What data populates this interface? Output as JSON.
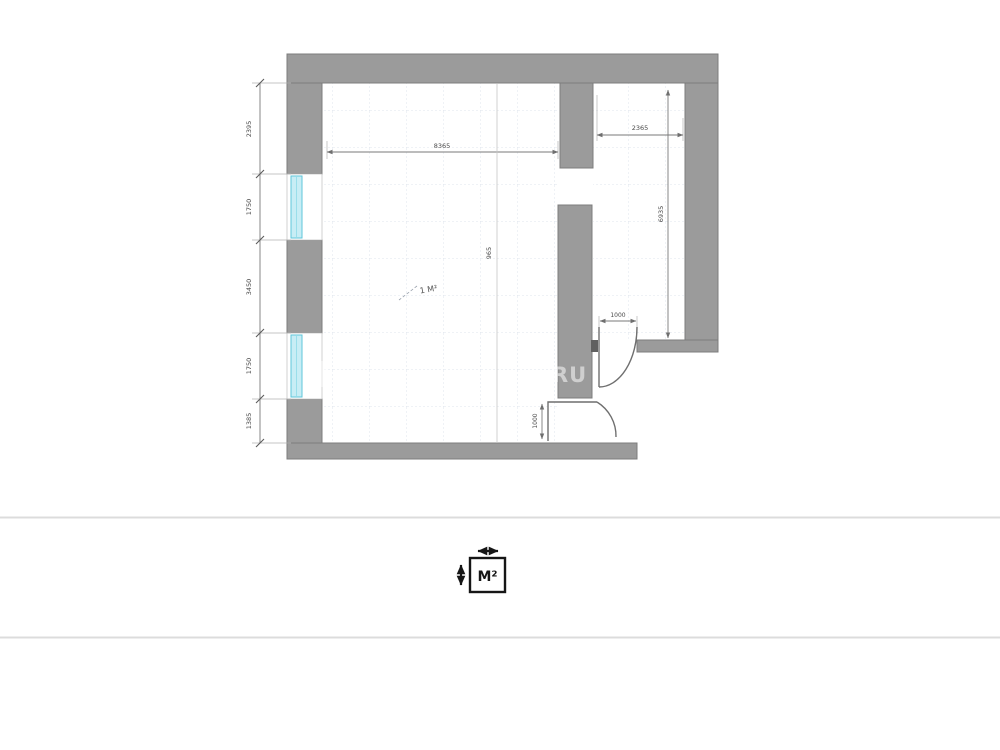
{
  "floor_plan": {
    "room_label": "1 М²",
    "watermark": "RU",
    "dimensions": {
      "left_chain": [
        "2395",
        "1750",
        "3450",
        "1750",
        "1385"
      ],
      "top_width": "8365",
      "right_room_width": "2365",
      "right_room_height": "6935",
      "center_height": "965",
      "door_right_width": "1000",
      "door_bottom_width": "1000"
    },
    "colors": {
      "wall": "#9b9b9b",
      "wall_outline": "#7c7c7c",
      "window_fill": "#c8edf5",
      "window_border": "#5fc6da",
      "dimension_text": "#4a4a4a",
      "grid": "#dfe4ec",
      "divider": "#dcdcdc",
      "watermark": "#ffffff",
      "icon": "#161616"
    }
  },
  "footer": {
    "area_icon_label": "M²"
  }
}
